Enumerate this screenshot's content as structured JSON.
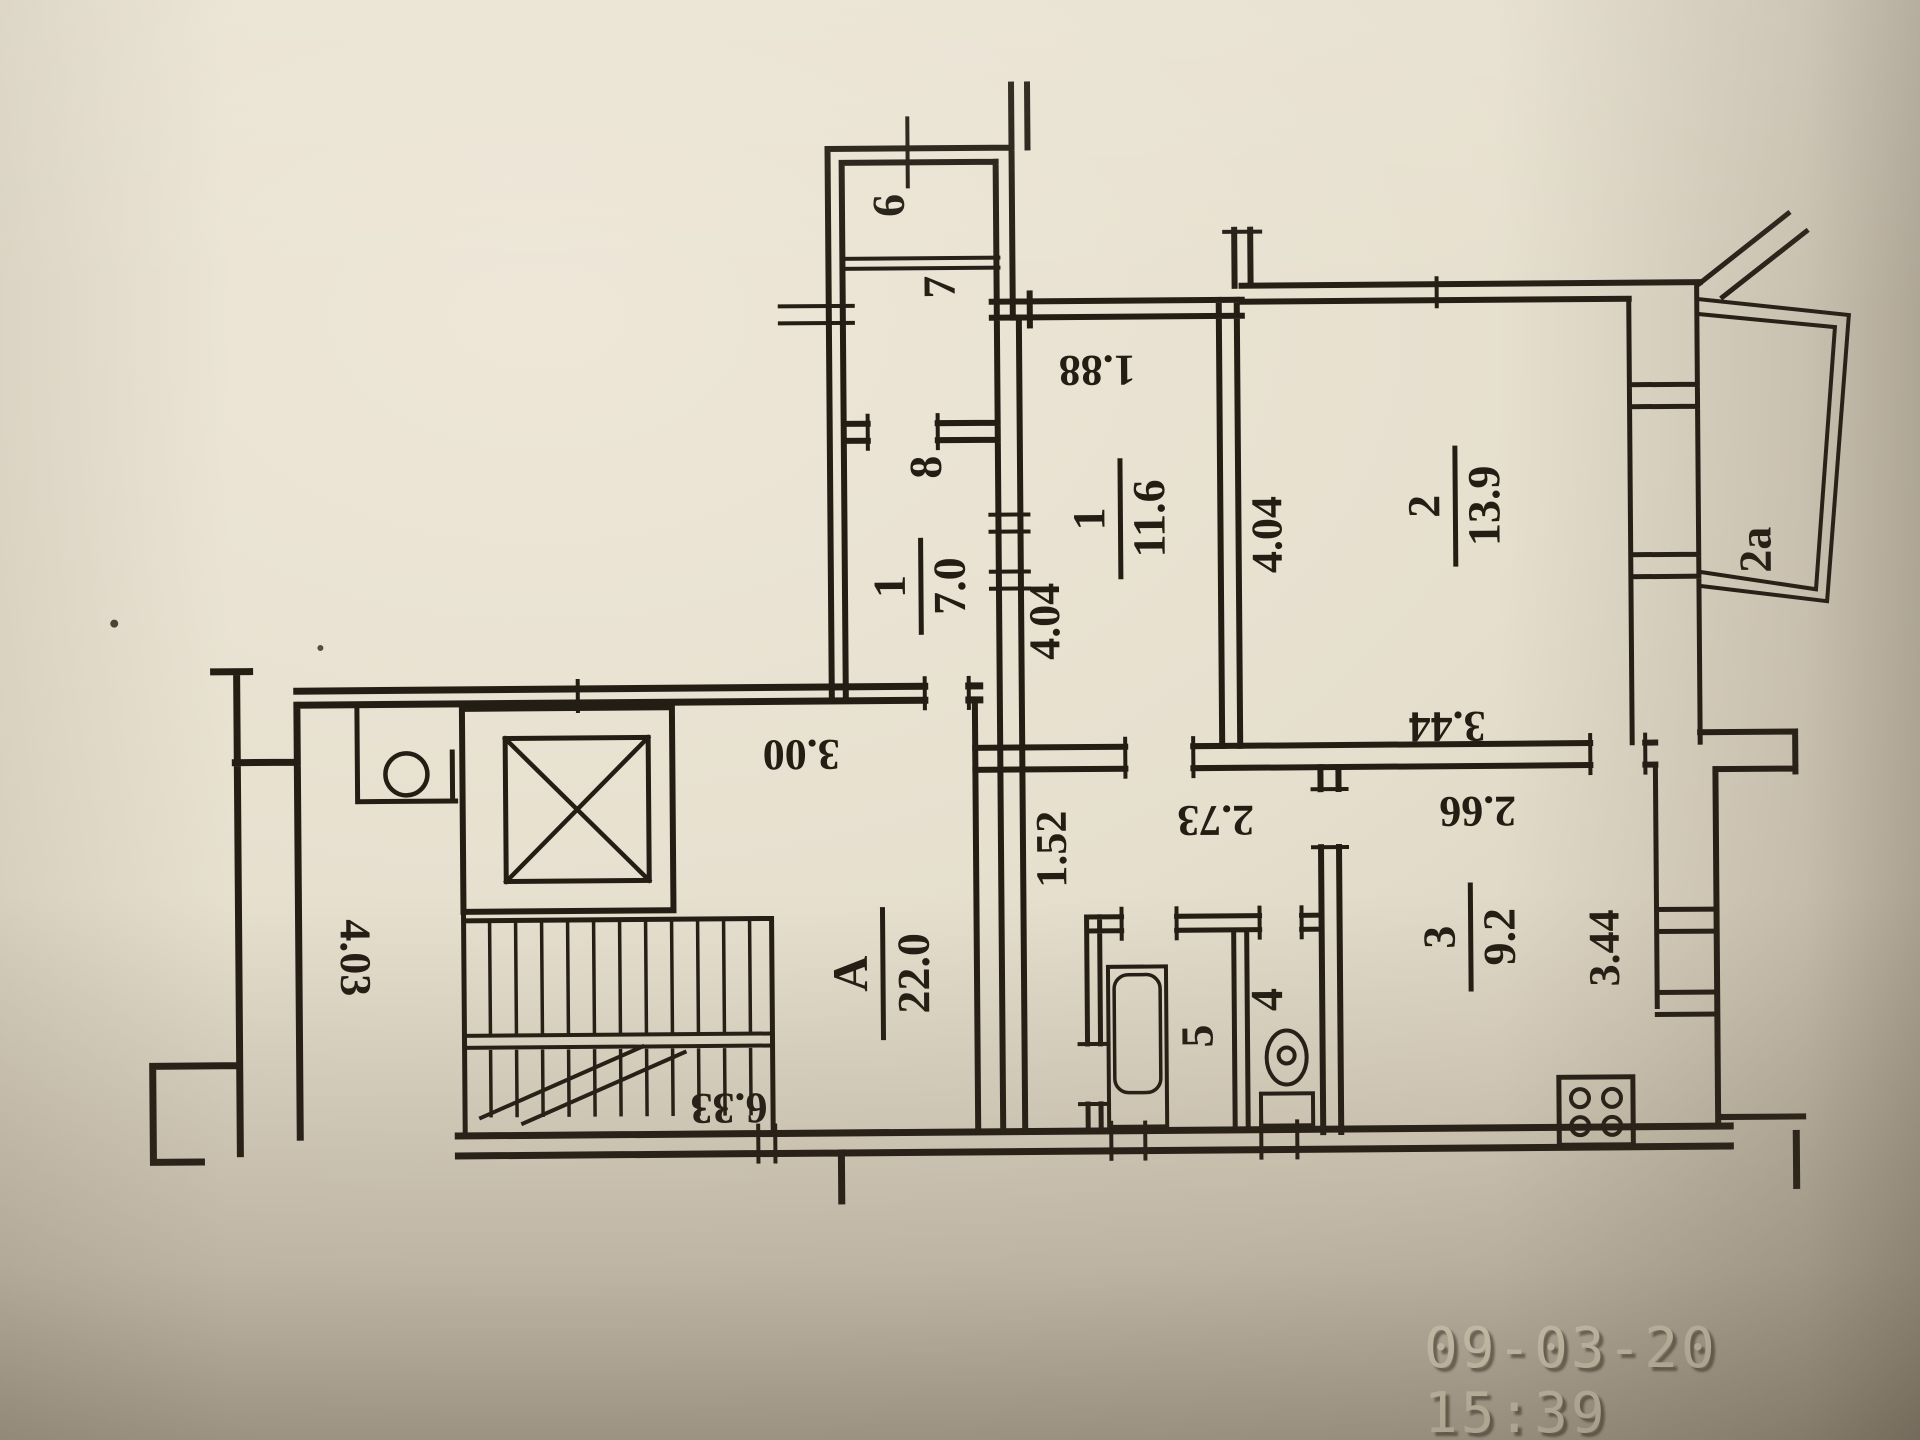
{
  "photo": {
    "timestamp": "09-03-20 15:39",
    "paper_color": "#e6dfce",
    "ink_color": "#241d14",
    "timestamp_color": "#f0e7d0"
  },
  "plan": {
    "rooms": {
      "balcony6": {
        "label": "6"
      },
      "room7": {
        "label": "7"
      },
      "room8": {
        "label": "8"
      },
      "hall1": {
        "number": "1",
        "area": "7.0"
      },
      "room1": {
        "number": "1",
        "area": "11.6"
      },
      "room2": {
        "number": "2",
        "area": "13.9"
      },
      "room3": {
        "number": "3",
        "area": "9.2"
      },
      "hallA": {
        "number": "A",
        "area": "22.0"
      },
      "bath": {
        "label": "5"
      },
      "wc": {
        "label": "4"
      },
      "balcony2a": {
        "label": "2a"
      }
    },
    "dims": {
      "d1_88": "1.88",
      "d4_04_room1": "4.04",
      "d4_04_room2": "4.04",
      "d3_44_room2": "3.44",
      "d3_44_room3": "3.44",
      "d2_66": "2.66",
      "d2_73": "2.73",
      "d1_52": "1.52",
      "d3_00": "3.00",
      "d4_03": "4.03",
      "d6_33": "6.33"
    }
  }
}
